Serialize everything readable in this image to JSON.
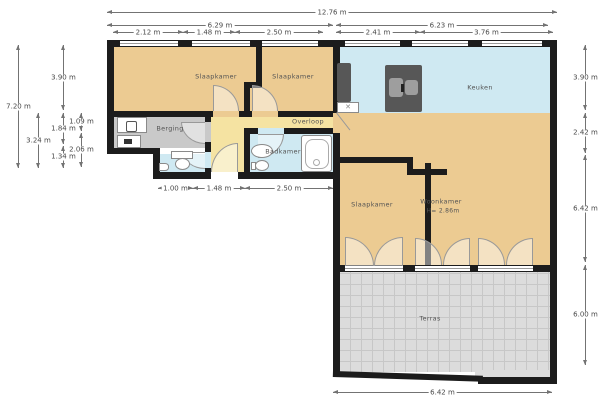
{
  "rooms": {
    "slaapkamer1": "Slaapkamer",
    "slaapkamer2": "Slaapkamer",
    "berging": "Berging",
    "overloop": "Overloop",
    "badkamer": "Badkamer",
    "keuken": "Keuken",
    "slaapkamer3": "Slaapkamer",
    "woonkamer": "Woonkamer",
    "woonkamer_height": "H= 2.86m",
    "terras": "Terras"
  },
  "dimensions": {
    "top_total": "12.76 m",
    "top_left": "6.29 m",
    "top_right": "6.23 m",
    "seg_212": "2.12 m",
    "seg_148": "1.48 m",
    "seg_250": "2.50 m",
    "seg_241": "2.41 m",
    "seg_376": "3.76 m",
    "left_720": "7.20 m",
    "left_390": "3.90 m",
    "left_324": "3.24 m",
    "left_184": "1.84 m",
    "left_109": "1.09 m",
    "left_206": "2.06 m",
    "left_134": "1.34 m",
    "hall_100": "1.00 m",
    "hall_148": "1.48 m",
    "hall_250": "2.50 m",
    "right_390": "3.90 m",
    "right_242": "2.42 m",
    "right_642": "6.42 m",
    "right_600": "6.00 m",
    "bottom_642": "6.42 m"
  },
  "colors": {
    "wall": "#1c1c1c",
    "floor_tan": "#eccb92",
    "floor_blue": "#cfe9f2",
    "floor_gray": "#c9c9c9",
    "floor_yellow": "#f5e3a2",
    "terrace_gray": "#dcdcdc",
    "dimension_line": "#737373"
  }
}
